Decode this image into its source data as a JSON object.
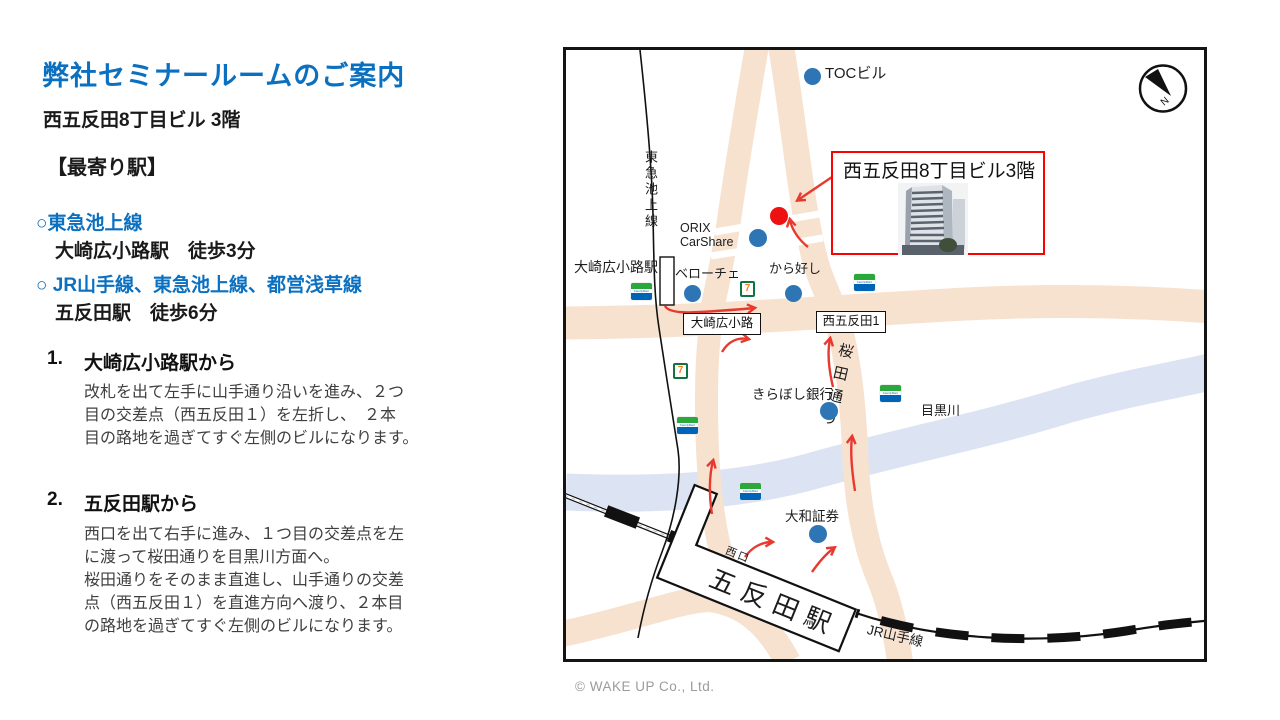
{
  "left_panel": {
    "title": "弊社セミナールームのご案内",
    "subtitle": "西五反田8丁目ビル 3階",
    "section_heading": "【最寄り駅】",
    "stations": [
      {
        "line": "○東急池上線",
        "detail": "大崎広小路駅　徒歩3分"
      },
      {
        "line": "○ JR山手線、東急池上線、都営浅草線",
        "detail": "五反田駅　徒歩6分"
      }
    ],
    "directions": [
      {
        "no": "1.",
        "heading": "大崎広小路駅から",
        "lines": [
          "改札を出て左手に山手通り沿いを進み、２つ",
          "目の交差点（西五反田１）を左折し、　２本",
          "目の路地を過ぎてすぐ左側のビルになります。"
        ]
      },
      {
        "no": "2.",
        "heading": "五反田駅から",
        "lines": [
          "西口を出て右手に進み、１つ目の交差点を左",
          "に渡って桜田通りを目黒川方面へ。",
          "桜田通りをそのまま直進し、山手通りの交差",
          "点（西五反田１）を直進方向へ渡り、２本目",
          "の路地を過ぎてすぐ左側のビルになります。"
        ]
      }
    ]
  },
  "map": {
    "labels": {
      "toc": "TOCビル",
      "tokyu_line": "東急池上線",
      "orix": "ORIX\nCarShare",
      "osaki_station": "大崎広小路駅",
      "veloce": "ベローチェ",
      "karayoshi": "から好し",
      "osaki_crossing": "大崎広小路",
      "nishigotanda_crossing": "西五反田1",
      "sakurada_dori": "桜田通り",
      "kiraboshi": "きらぼし銀行",
      "meguro_river": "目黒川",
      "daiwa": "大和証券",
      "west_exit": "西口",
      "gotanda_station": "五反田駅",
      "jr_yamanote": "JR山手線",
      "compass_n": "N"
    },
    "destination_label": "西五反田8丁目ビル3階",
    "seven_eleven_glyph": "7",
    "familymart_text": "FamilyMart",
    "colors": {
      "road": "#f7e2d0",
      "river": "#dce3f2",
      "marker": "#2e75b6",
      "destination_dot": "#ee1111",
      "route_arrow": "#e8392f",
      "callout_border": "#ff0000"
    }
  },
  "footer": {
    "copyright": "© WAKE UP Co., Ltd."
  }
}
